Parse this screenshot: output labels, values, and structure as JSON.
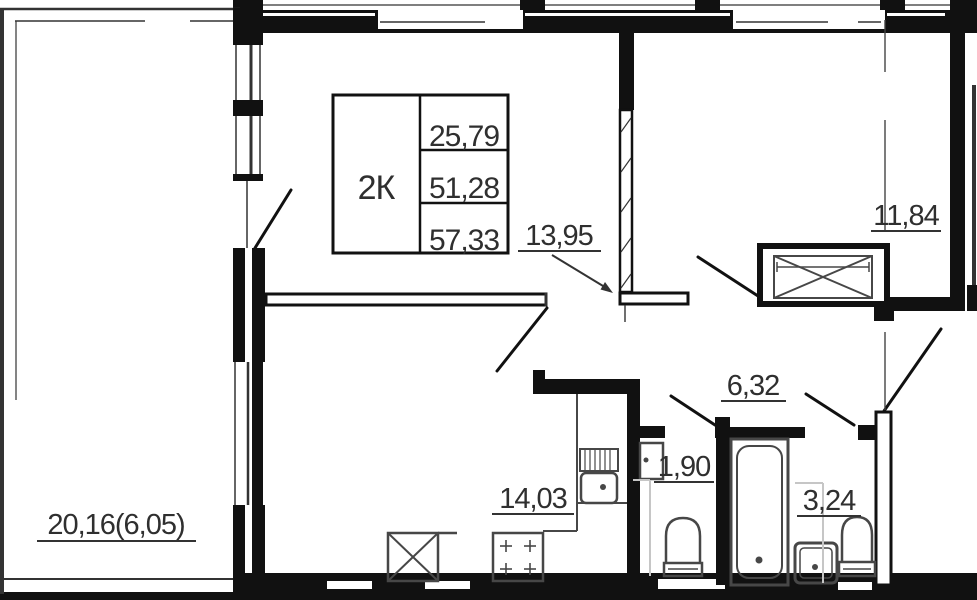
{
  "plan": {
    "title": "2-room apartment floor plan",
    "info_table": {
      "type": "2К",
      "living_area": "25,79",
      "apartment_area": "51,28",
      "total_area": "57,33"
    },
    "labels": {
      "living": "13,95",
      "bedroom": "11,84",
      "kitchen": "14,03",
      "hallway": "6,32",
      "toilet": "1,90",
      "bathroom": "3,24",
      "balcony": "20,16(6,05)"
    },
    "colors": {
      "wall": "#111111",
      "text": "#2f2f2f",
      "fixture_line": "#474747",
      "shaft_line": "#c6c6c6",
      "background": "#ffffff"
    }
  }
}
